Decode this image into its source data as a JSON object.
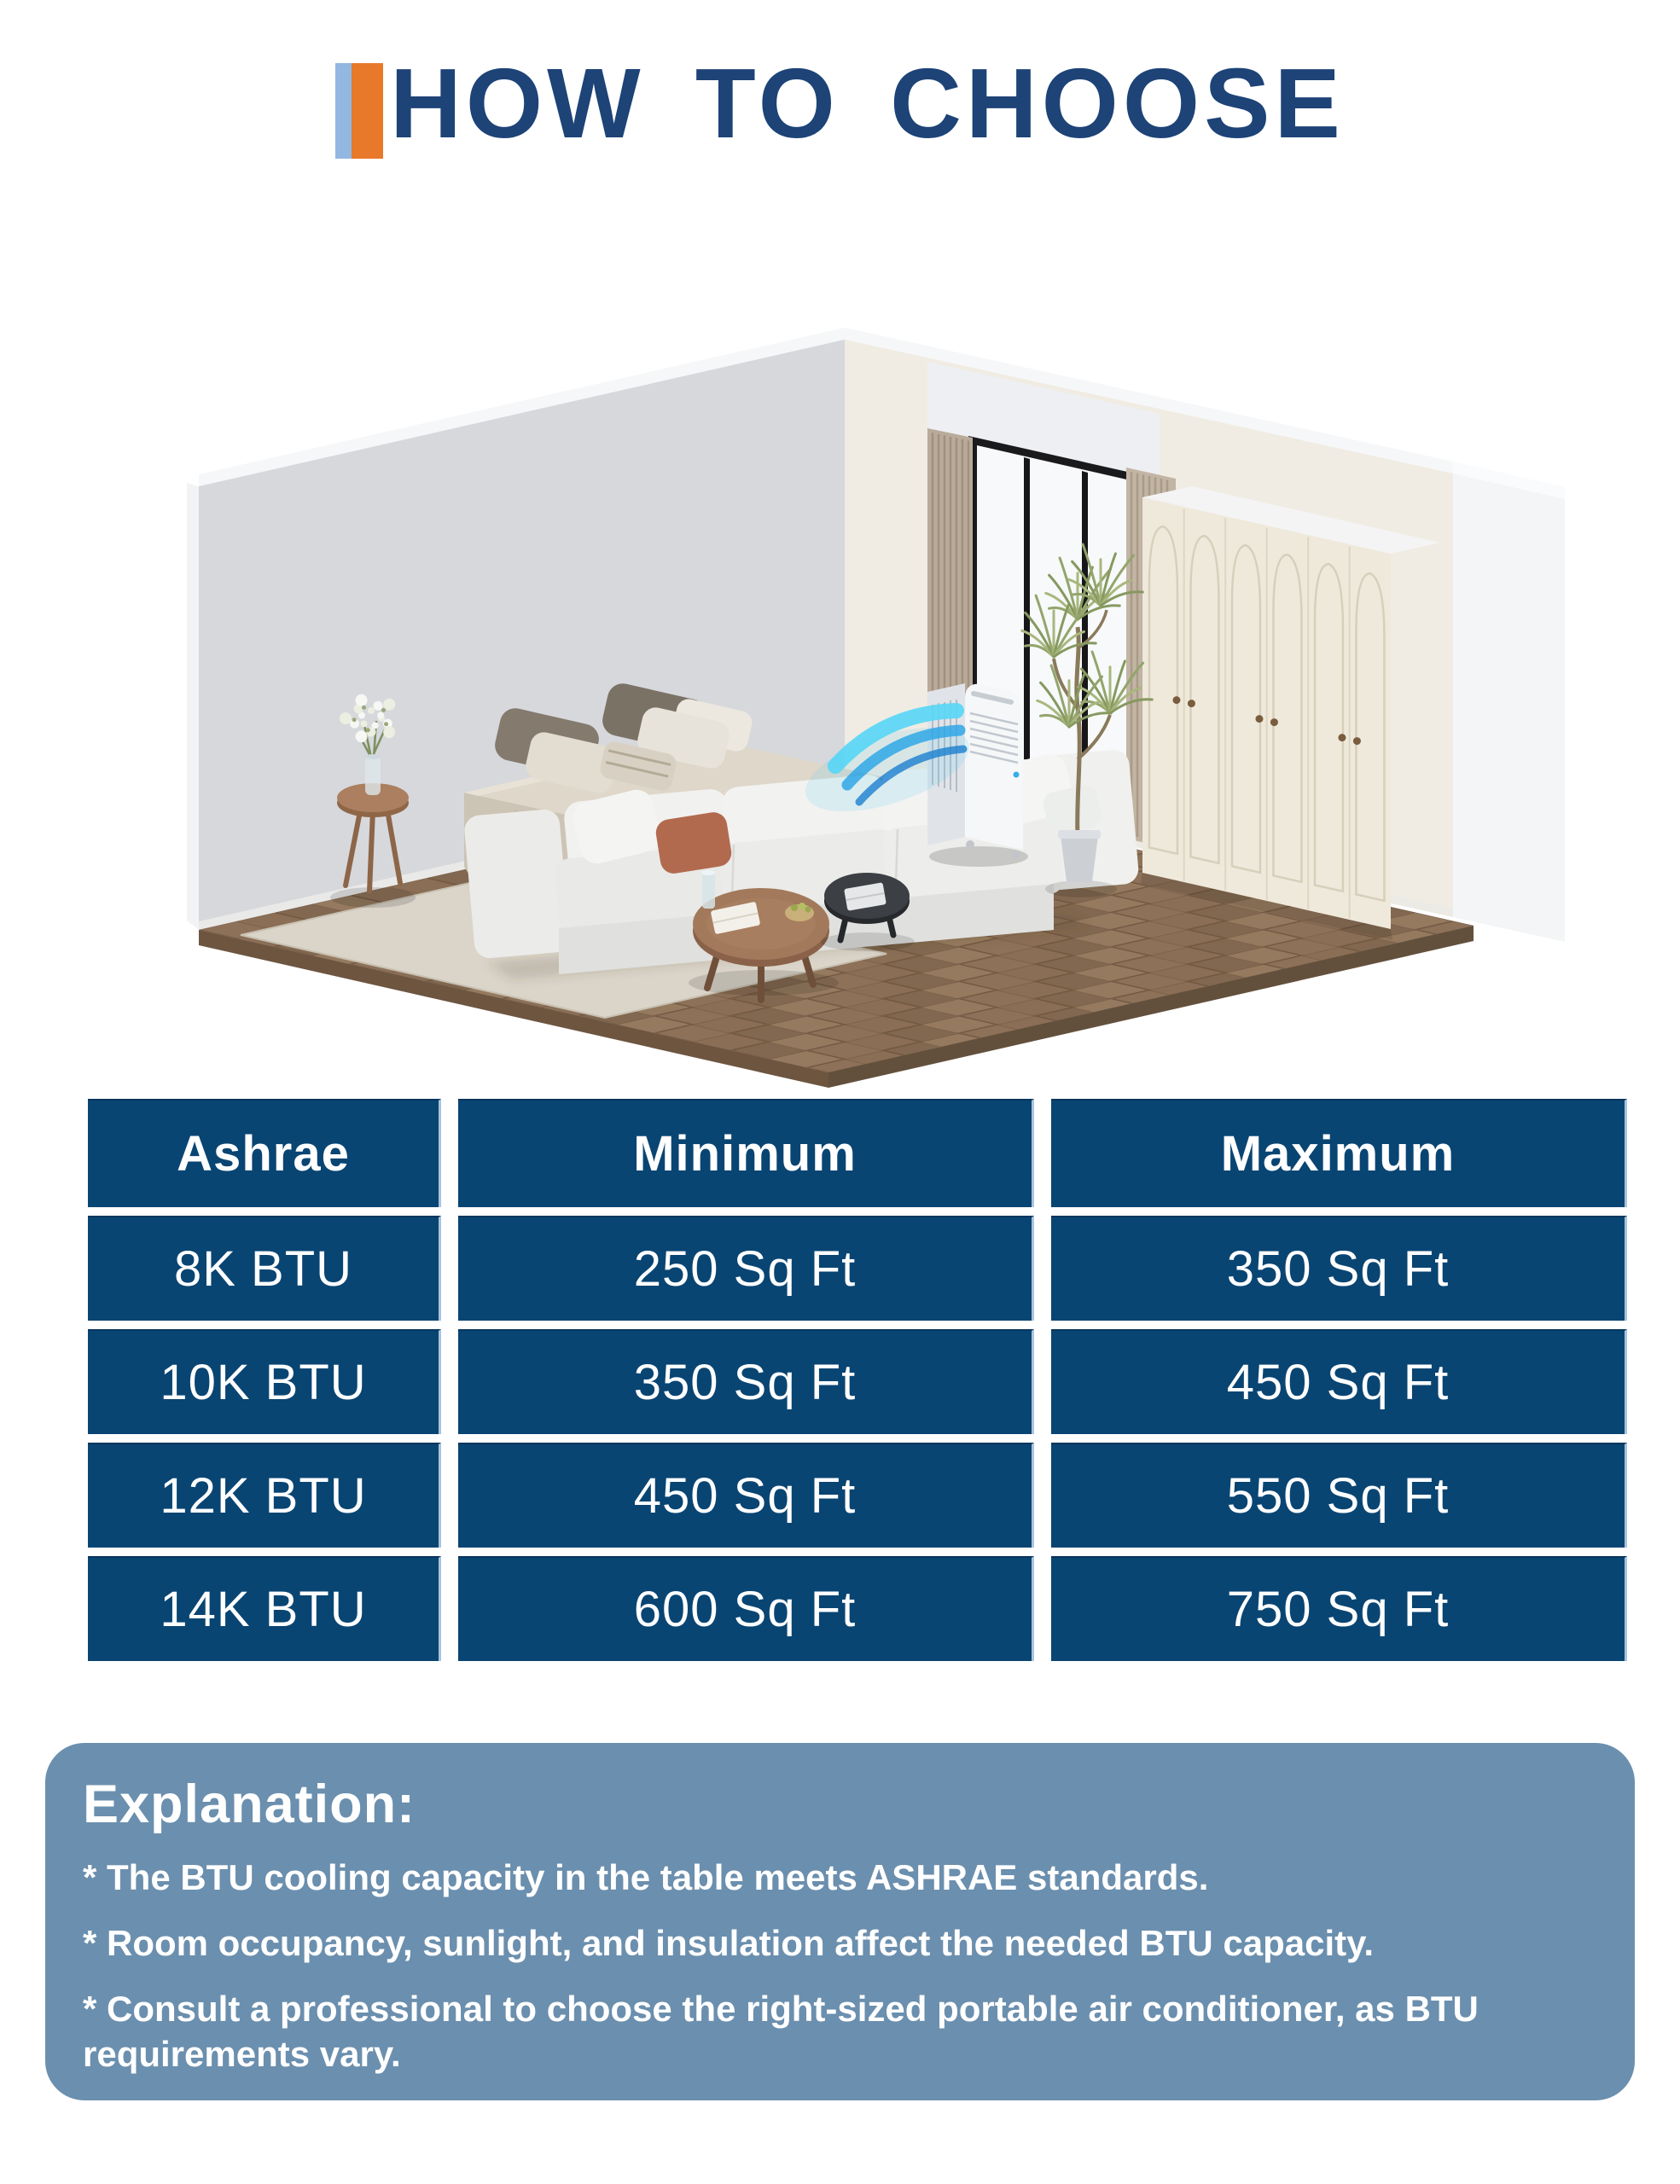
{
  "header": {
    "title": "HOW TO CHOOSE"
  },
  "illustration": {
    "name": "isometric-bedroom-with-portable-ac",
    "description": "Isometric bedroom with bed, modular sofa, coffee tables, rug, wardrobe with arched doors, window with curtains, tall plant, and a portable air conditioner blowing cool blue air"
  },
  "table": {
    "columns": [
      "Ashrae",
      "Minimum",
      "Maximum"
    ],
    "rows": [
      [
        "8K BTU",
        "250 Sq Ft",
        "350 Sq Ft"
      ],
      [
        "10K BTU",
        "350 Sq Ft",
        "450 Sq Ft"
      ],
      [
        "12K BTU",
        "450 Sq Ft",
        "550 Sq Ft"
      ],
      [
        "14K BTU",
        "600 Sq Ft",
        "750 Sq Ft"
      ]
    ]
  },
  "explanation": {
    "heading": "Explanation:",
    "bullets": [
      "* The BTU cooling capacity in the table meets ASHRAE standards.",
      "* Room occupancy, sunlight, and insulation affect the needed BTU capacity.",
      "* Consult a professional to choose the right-sized portable air conditioner, as  BTU requirements vary."
    ]
  },
  "colors": {
    "accent_light_blue": "#92b7e0",
    "accent_orange": "#e8782a",
    "title_navy": "#1d4377",
    "table_cell_blue": "#094573",
    "table_text": "#ffffff",
    "explanation_background": "#6b8fae",
    "explanation_text": "#ffffff",
    "airflow_cyan": "#49c9f0",
    "floor_wood": "#8a6e55"
  }
}
